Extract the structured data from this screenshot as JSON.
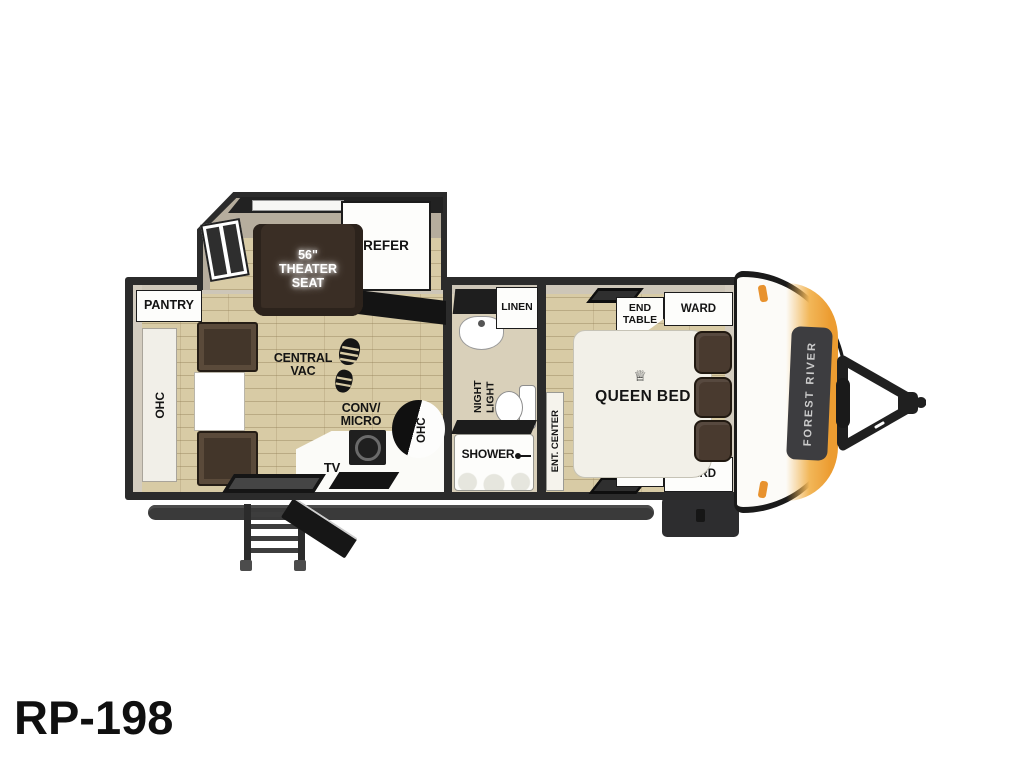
{
  "model": {
    "name": "RP-198"
  },
  "brand": {
    "front_decal": "FOREST RIVER"
  },
  "living": {
    "pantry": "PANTRY",
    "ohc_rear": "OHC",
    "theater_seat": "56\"\nTHEATER\nSEAT",
    "refer": "REFER",
    "central_vac": "CENTRAL\nVAC",
    "conv_micro": "CONV/\nMICRO",
    "tv": "TV",
    "ohc_kitchen": "OHC",
    "ohc_counter_end": "OHC"
  },
  "bath": {
    "linen": "LINEN",
    "night_light": "NIGHT\nLIGHT",
    "shower": "SHOWER"
  },
  "bedroom": {
    "ent_center": "ENT. CENTER",
    "end_table_top": "END\nTABLE",
    "ward_top": "WARD",
    "queen_bed": "QUEEN BED",
    "crown_icon": "♕",
    "end_table_bottom": "END\nTABLE",
    "ward_bottom": "WARD"
  },
  "colors": {
    "wall": "#2b2b2b",
    "floor_plank": "#d8cba5",
    "accent_orange": "#ec9c31",
    "seat_brown": "#3a2e25",
    "cap_white": "#fcfbf8"
  }
}
